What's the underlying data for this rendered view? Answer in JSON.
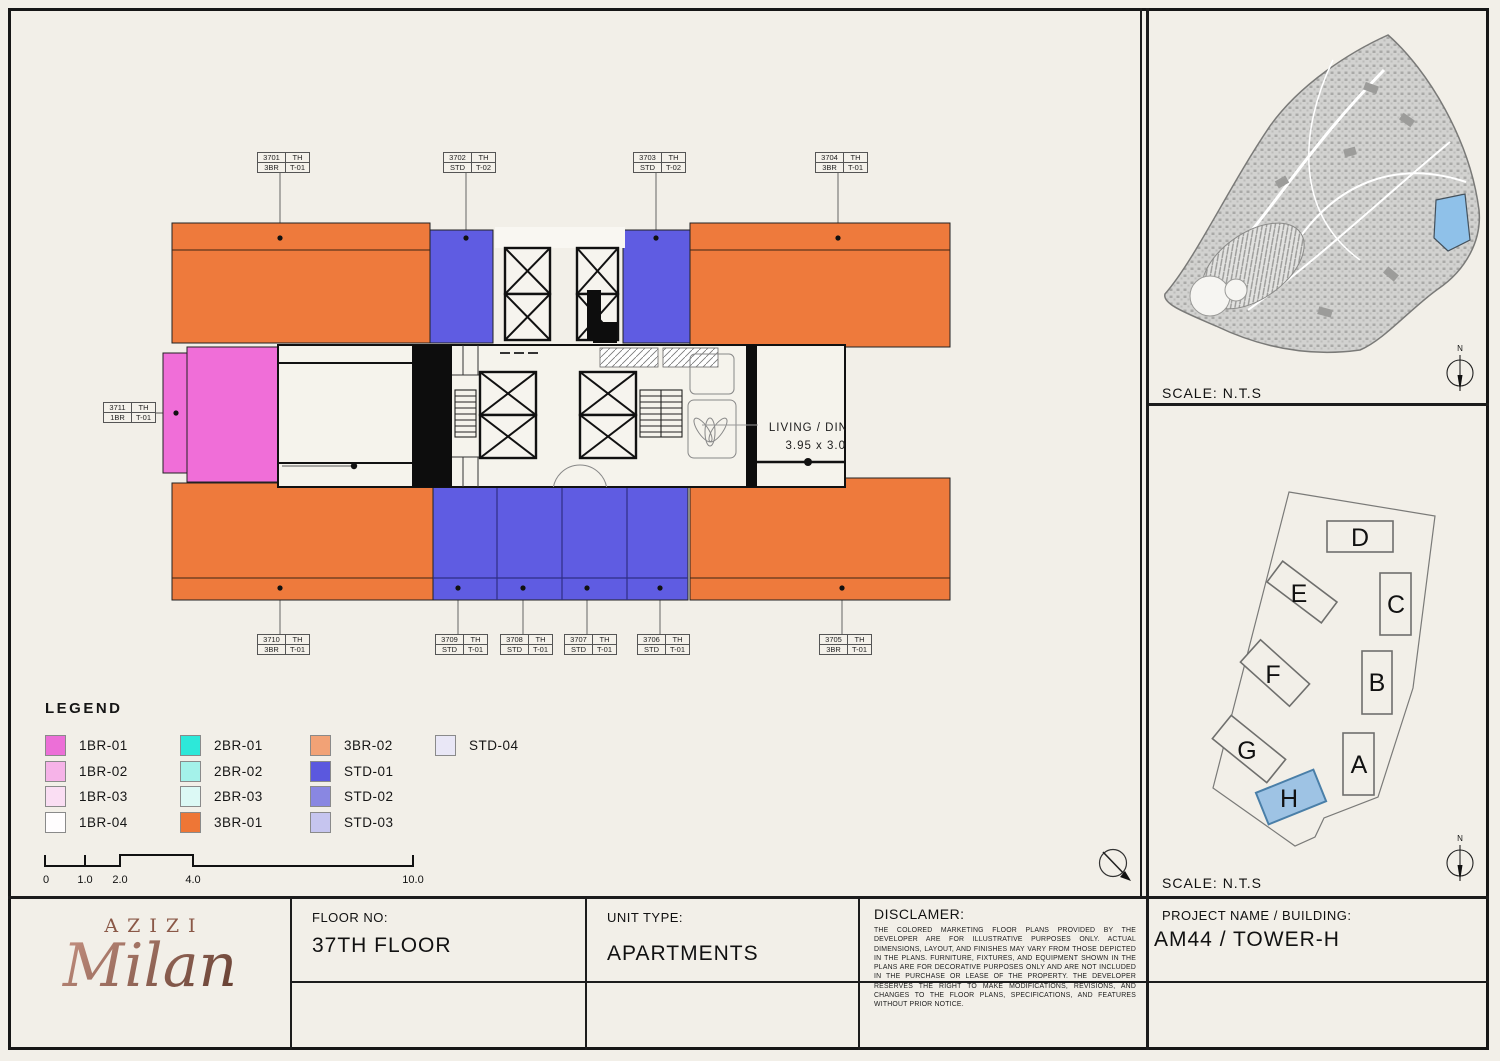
{
  "sheet": {
    "background": "#f2efe8",
    "frame_color": "#161616"
  },
  "site_map_panel": {
    "scale_label": "SCALE: N.T.S",
    "north_label": "N",
    "highlight_color": "#8fc1e9"
  },
  "towers_panel": {
    "scale_label": "SCALE: N.T.S",
    "north_label": "N",
    "highlighted_tower": "H",
    "highlight_fill": "#9ec3e4",
    "towers": [
      {
        "label": "A"
      },
      {
        "label": "B"
      },
      {
        "label": "C"
      },
      {
        "label": "D"
      },
      {
        "label": "E"
      },
      {
        "label": "F"
      },
      {
        "label": "G"
      },
      {
        "label": "H"
      }
    ]
  },
  "plan": {
    "living_label": "LIVING / DIN",
    "living_dims": "3.95 x 3.0",
    "colors": {
      "orange": "#ee7a3c",
      "blue": "#5f5ce2",
      "pink": "#f06ed8",
      "wall": "#0d0d0d",
      "room": "#f5f3ec",
      "core_white": "#f9f7f2"
    },
    "labels": [
      {
        "num": "3701",
        "fl": "TH",
        "type": "3BR",
        "variant": "T-01"
      },
      {
        "num": "3702",
        "fl": "TH",
        "type": "STD",
        "variant": "T-02"
      },
      {
        "num": "3703",
        "fl": "TH",
        "type": "STD",
        "variant": "T-02"
      },
      {
        "num": "3704",
        "fl": "TH",
        "type": "3BR",
        "variant": "T-01"
      },
      {
        "num": "3711",
        "fl": "TH",
        "type": "1BR",
        "variant": "T-01"
      },
      {
        "num": "3710",
        "fl": "TH",
        "type": "3BR",
        "variant": "T-01"
      },
      {
        "num": "3709",
        "fl": "TH",
        "type": "STD",
        "variant": "T-01"
      },
      {
        "num": "3708",
        "fl": "TH",
        "type": "STD",
        "variant": "T-01"
      },
      {
        "num": "3707",
        "fl": "TH",
        "type": "STD",
        "variant": "T-01"
      },
      {
        "num": "3706",
        "fl": "TH",
        "type": "STD",
        "variant": "T-01"
      },
      {
        "num": "3705",
        "fl": "TH",
        "type": "3BR",
        "variant": "T-01"
      }
    ]
  },
  "legend": {
    "title": "LEGEND",
    "items": [
      {
        "label": "1BR-01",
        "color": "#ec6fd7"
      },
      {
        "label": "1BR-02",
        "color": "#f6b3e8"
      },
      {
        "label": "1BR-03",
        "color": "#fadef3"
      },
      {
        "label": "1BR-04",
        "color": "#fffdfe"
      },
      {
        "label": "2BR-01",
        "color": "#2de8d9"
      },
      {
        "label": "2BR-02",
        "color": "#a4f2ea"
      },
      {
        "label": "2BR-03",
        "color": "#dcf9f5"
      },
      {
        "label": "3BR-01",
        "color": "#ee7636"
      },
      {
        "label": "3BR-02",
        "color": "#f2a276"
      },
      {
        "label": "STD-01",
        "color": "#5b58de"
      },
      {
        "label": "STD-02",
        "color": "#8987e2"
      },
      {
        "label": "STD-03",
        "color": "#c6c5ef"
      },
      {
        "label": "STD-04",
        "color": "#e9e7f6"
      }
    ]
  },
  "scale_bar": {
    "ticks": [
      "0",
      "1.0",
      "2.0",
      "4.0",
      "10.0"
    ]
  },
  "title_block": {
    "brand_name": "AZIZI",
    "brand_script": "Milan",
    "floor_label": "FLOOR NO:",
    "floor_value": "37TH FLOOR",
    "unit_label": "UNIT TYPE:",
    "unit_value": "APARTMENTS",
    "disclaimer_label": "DISCLAMER:",
    "disclaimer_text": "THE COLORED MARKETING FLOOR PLANS PROVIDED BY THE DEVELOPER ARE FOR ILLUSTRATIVE PURPOSES ONLY. ACTUAL DIMENSIONS, LAYOUT, AND FINISHES MAY VARY FROM THOSE DEPICTED IN THE PLANS. FURNITURE, FIXTURES, AND EQUIPMENT SHOWN IN THE PLANS ARE FOR DECORATIVE PURPOSES ONLY AND ARE NOT INCLUDED IN THE PURCHASE OR LEASE OF THE PROPERTY. THE DEVELOPER RESERVES THE RIGHT TO MAKE MODIFICATIONS, REVISIONS, AND CHANGES TO THE FLOOR PLANS, SPECIFICATIONS, AND FEATURES WITHOUT PRIOR NOTICE.",
    "project_label": "PROJECT NAME / BUILDING:",
    "project_value": "AM44 / TOWER-H"
  }
}
